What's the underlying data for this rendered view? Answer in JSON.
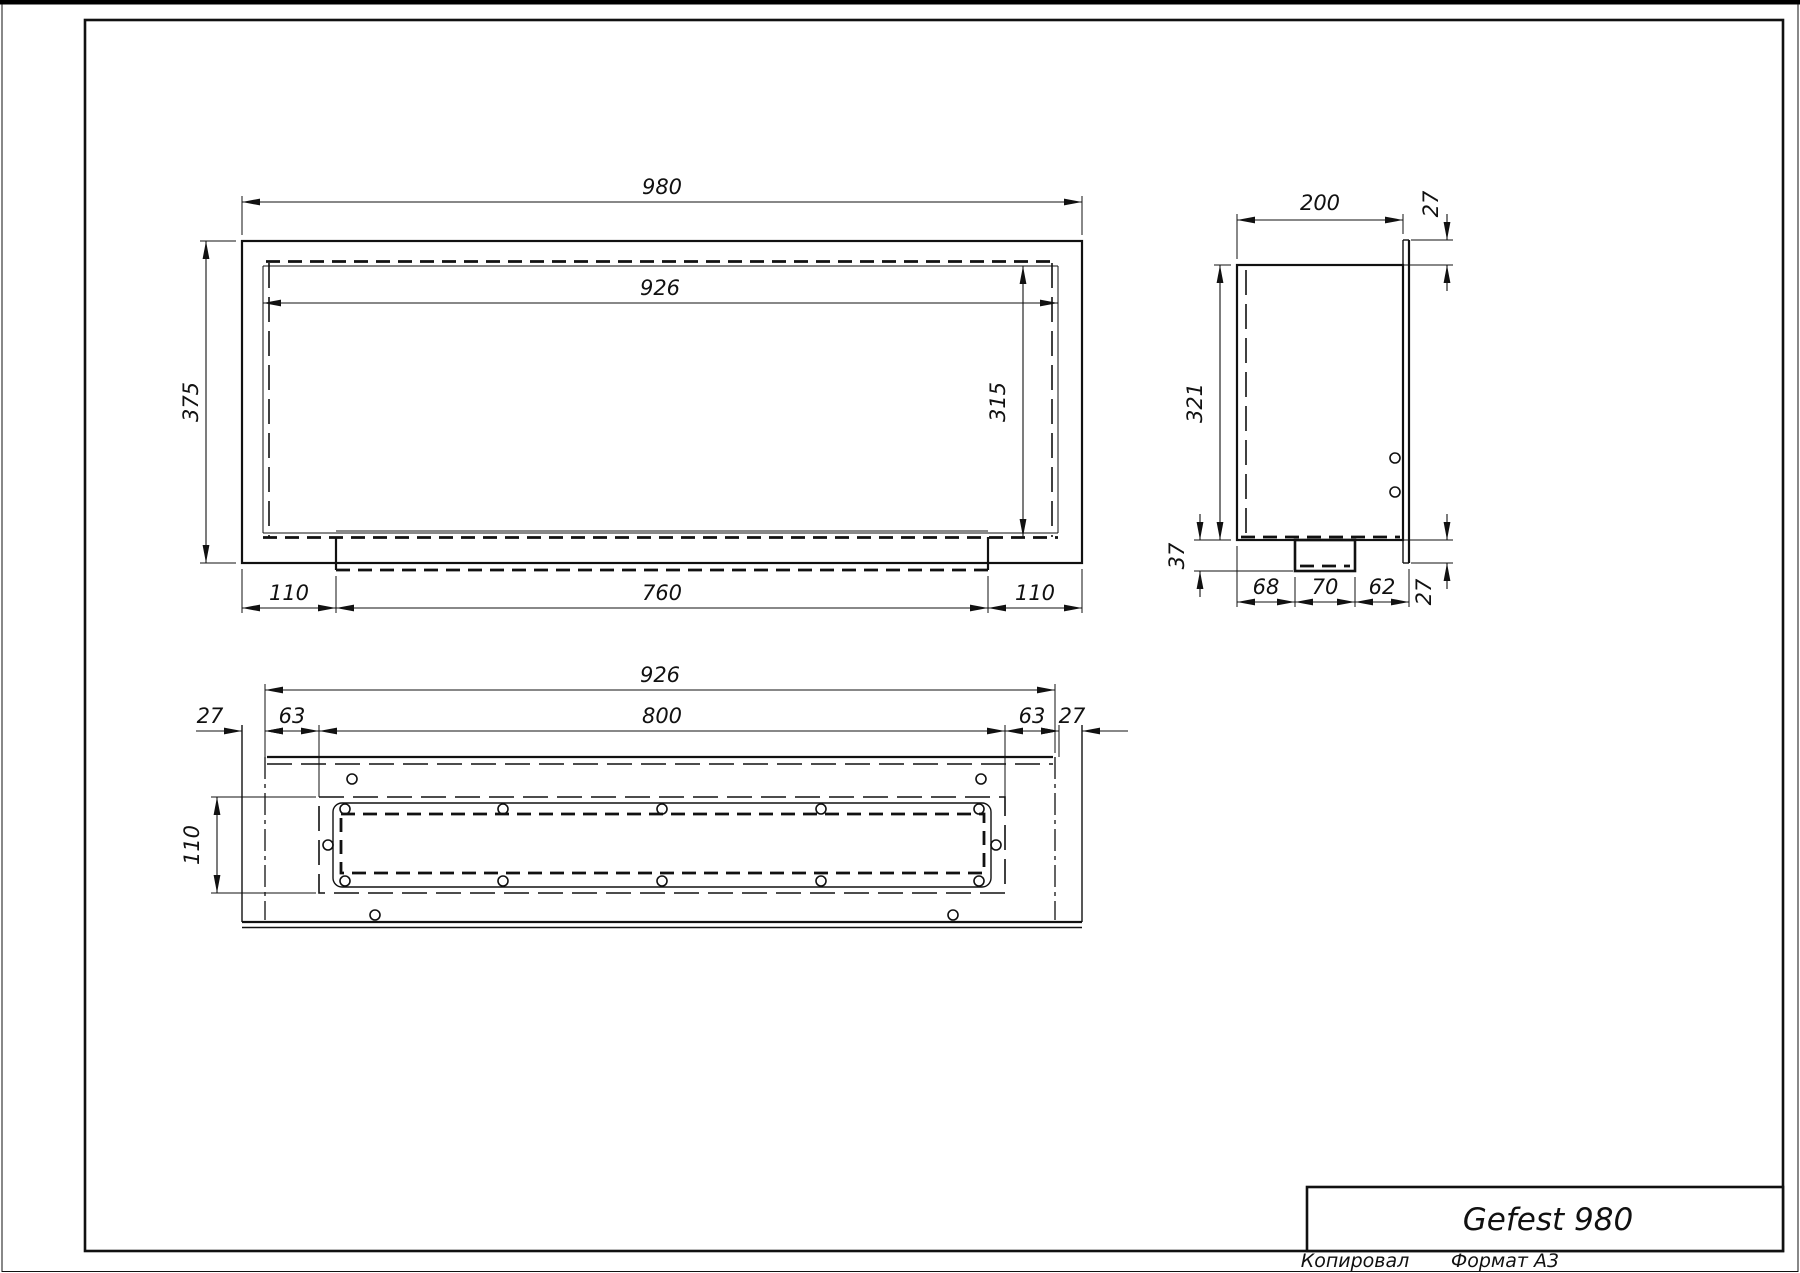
{
  "front_view": {
    "w_overall": "980",
    "w_inner": "926",
    "h_overall": "375",
    "h_inner": "315",
    "b_left": "110",
    "b_mid": "760",
    "b_right": "110"
  },
  "side_view": {
    "depth": "200",
    "flange_top": "27",
    "height": "321",
    "drop": "37",
    "b1": "68",
    "b2": "70",
    "b3": "62",
    "flange_bottom": "27"
  },
  "bottom_view": {
    "w_inner": "926",
    "opening_w": "800",
    "f_left": "27",
    "o_left": "63",
    "o_right": "63",
    "f_right": "27",
    "opening_h": "110"
  },
  "title_block": {
    "title": "Gefest 980"
  },
  "footer": {
    "copied": "Копировал",
    "format": "Формат А3"
  }
}
